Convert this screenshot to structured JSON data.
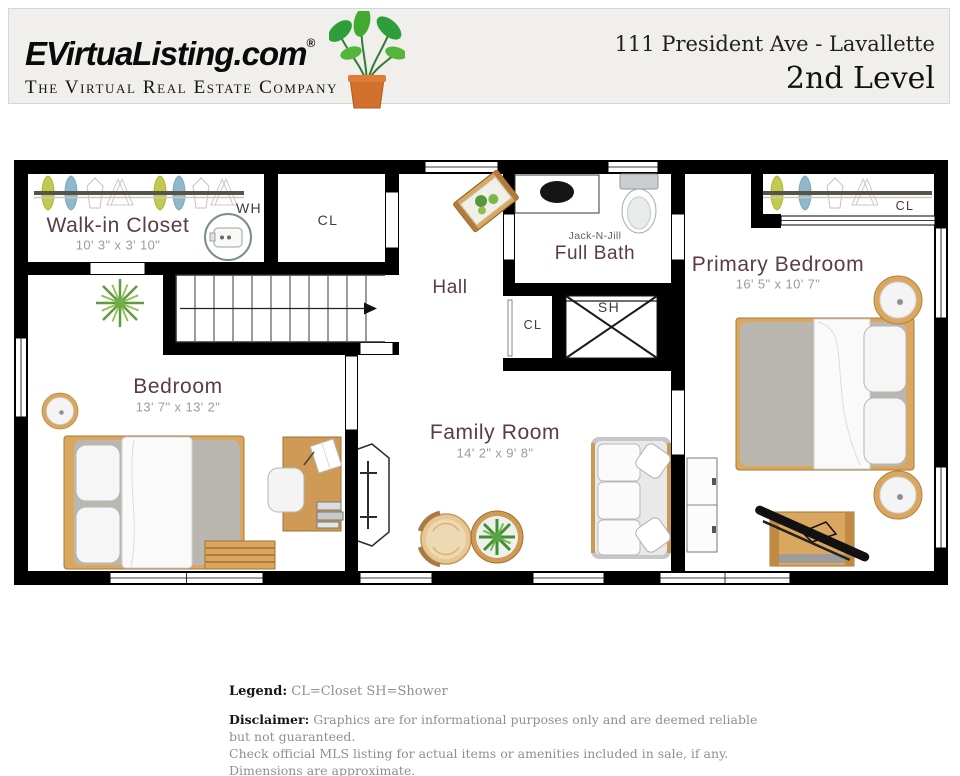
{
  "header": {
    "brand": "EVirtuaListing.com",
    "registered": "®",
    "tagline": "The Virtual Real Estate Company",
    "address": "111 President Ave - Lavallette",
    "level": "2nd Level"
  },
  "plan": {
    "walk_in_closet": {
      "label": "Walk-in Closet",
      "dims": "10' 3\" x 3' 10\""
    },
    "bedroom": {
      "label": "Bedroom",
      "dims": "13' 7\" x 13' 2\""
    },
    "hall": {
      "label": "Hall"
    },
    "bath": {
      "sublabel": "Jack-N-Jill",
      "label": "Full Bath"
    },
    "family_room": {
      "label": "Family Room",
      "dims": "14' 2\" x 9' 8\""
    },
    "primary_bedroom": {
      "label": "Primary Bedroom",
      "dims": "16' 5\" x 10' 7\""
    },
    "abbr": {
      "closet": "CL",
      "shower": "SH",
      "water_heater": "WH"
    }
  },
  "legend": {
    "label": "Legend:",
    "text": "CL=Closet SH=Shower"
  },
  "disclaimer": {
    "label": "Disclaimer:",
    "line1": "Graphics are for informational purposes only and are deemed reliable but not guaranteed.",
    "line2": "Check official MLS listing for actual items or amenities included in sale, if any.  Dimensions are approximate."
  },
  "colors": {
    "wall": "#000000",
    "room_label": "#5a3c42",
    "dimension": "#9b9b9b",
    "wood": "#d9a75f",
    "clothes_green": "#c2cb4e",
    "clothes_blue": "#8fb9cb",
    "header_bg": "#f0efec"
  }
}
